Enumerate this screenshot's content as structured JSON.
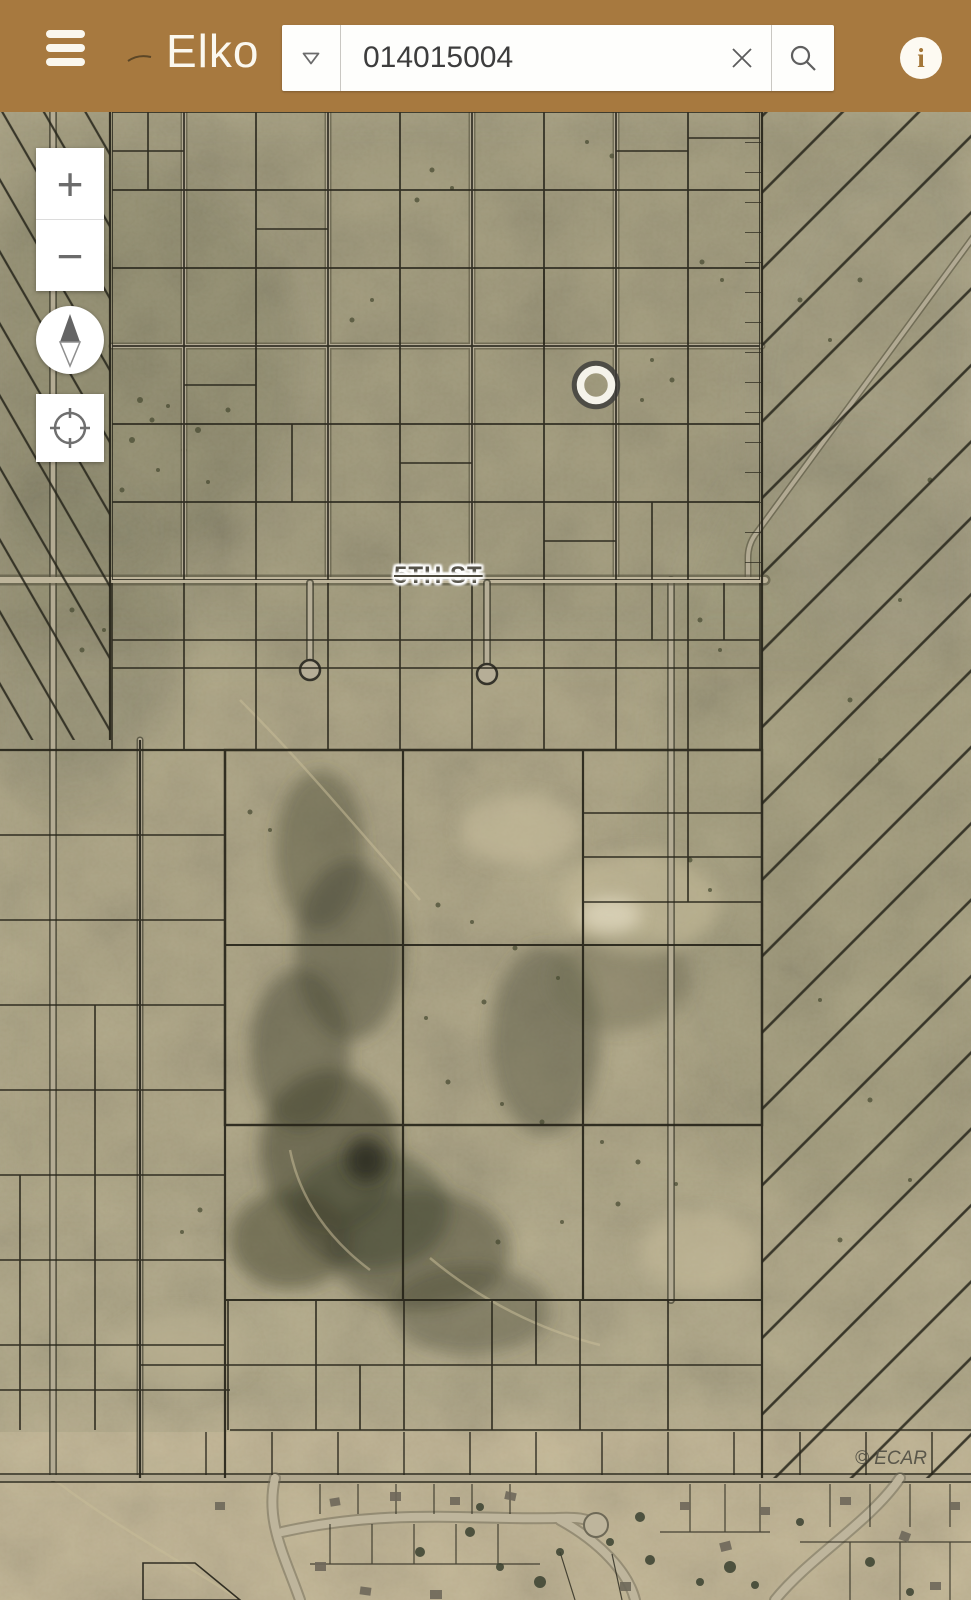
{
  "app": {
    "title": "Elko"
  },
  "header": {
    "search": {
      "value": "014015004"
    }
  },
  "icons": {
    "menu": "hamburger",
    "dropdown": "triangle-down-outline",
    "clear": "x",
    "search": "magnifier",
    "info": "i",
    "zoom_in": "+",
    "zoom_out": "−",
    "compass": "north-needle",
    "locate": "crosshair-circle"
  },
  "map": {
    "street_label": "5TH ST",
    "attribution": "© ECAR",
    "marker": {
      "x": 596,
      "y": 385
    }
  },
  "colors": {
    "header_bg": "#a7793f",
    "control_bg": "#ffffff",
    "map_base": "#b0a786",
    "parcel_line": "#26241a",
    "road_fill": "#b7af98",
    "marker_ring": "#f5f3ea",
    "marker_halo": "#3a3a38",
    "street_label_text": "#56534a",
    "attribution_text": "#4f4d42"
  }
}
